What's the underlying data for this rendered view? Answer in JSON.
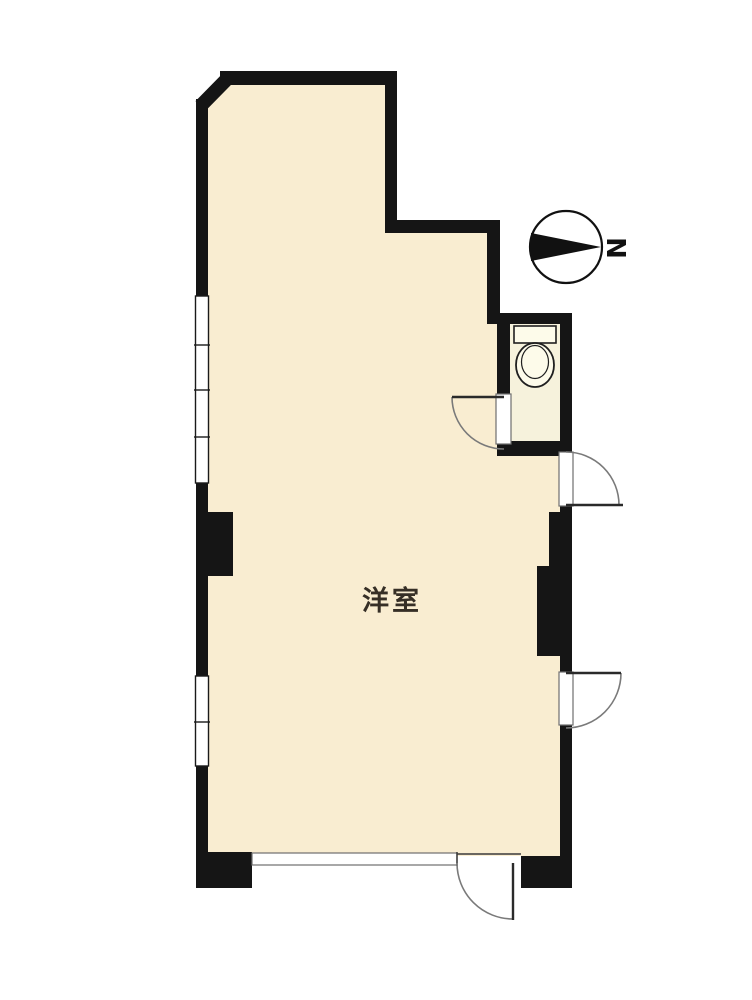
{
  "floor_plan": {
    "room_label": "洋室",
    "compass": {
      "letter": "N",
      "orientation": "needle-points-right-toward-N"
    },
    "colors": {
      "wall": "#151515",
      "room_fill": "#f9edd1",
      "toilet_room_fill": "#f6f2dc",
      "fixture_fill": "#fdfbea",
      "door_arc_line": "#7a7a7a",
      "background": "#ffffff"
    },
    "features": {
      "main_room": "western-style-room",
      "toilet": "toilet-room-with-bowl-and-tank",
      "windows_left_wall": 2,
      "swing_doors": 4,
      "bottom_opening": "sliding-window-track"
    }
  }
}
